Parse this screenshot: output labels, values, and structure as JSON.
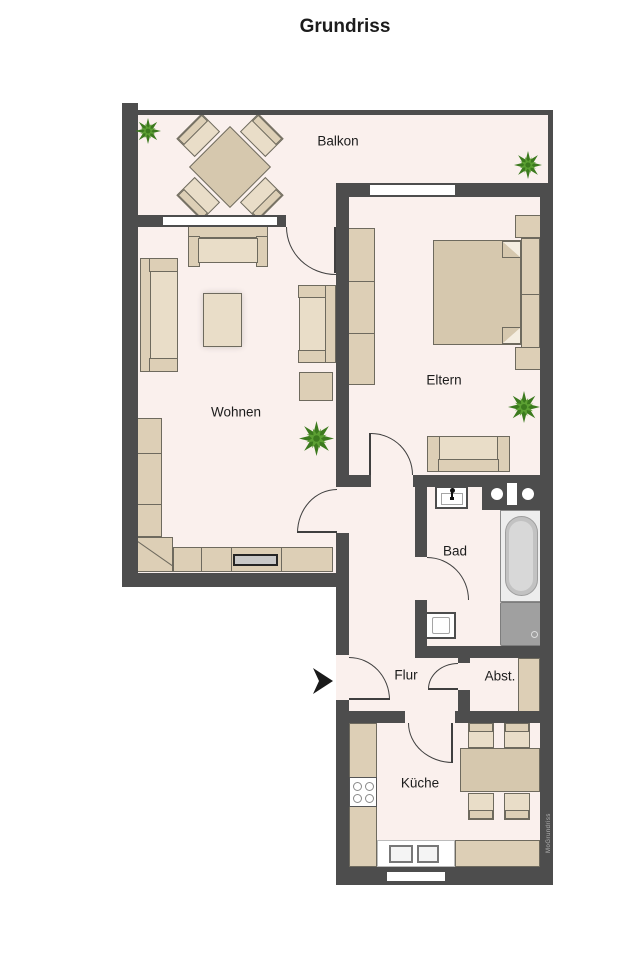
{
  "title": "Grundriss",
  "watermark": "MoGrundriss",
  "rooms": {
    "balcony": "Balkon",
    "living": "Wohnen",
    "parents": "Eltern",
    "bath": "Bad",
    "hall": "Flur",
    "storage": "Abst.",
    "kitchen": "Küche"
  },
  "colors": {
    "wall": "#4d4d4d",
    "floor": "#faf0ed",
    "door_line": "#3f3f3f",
    "furniture": "#ddcfb6",
    "furniture_light": "#e9ddc8",
    "furniture_dark": "#d6c8ae",
    "furniture_border": "#6e6a5e",
    "plant_dark": "#3c7a1e",
    "plant_light": "#5ca033",
    "fixture_border": "#8a8a8a",
    "fixture_fill": "#ededed",
    "shower_fill": "#a0a0a0",
    "tv_fill": "#c8c8c8",
    "label_color": "#1c1c1c"
  }
}
